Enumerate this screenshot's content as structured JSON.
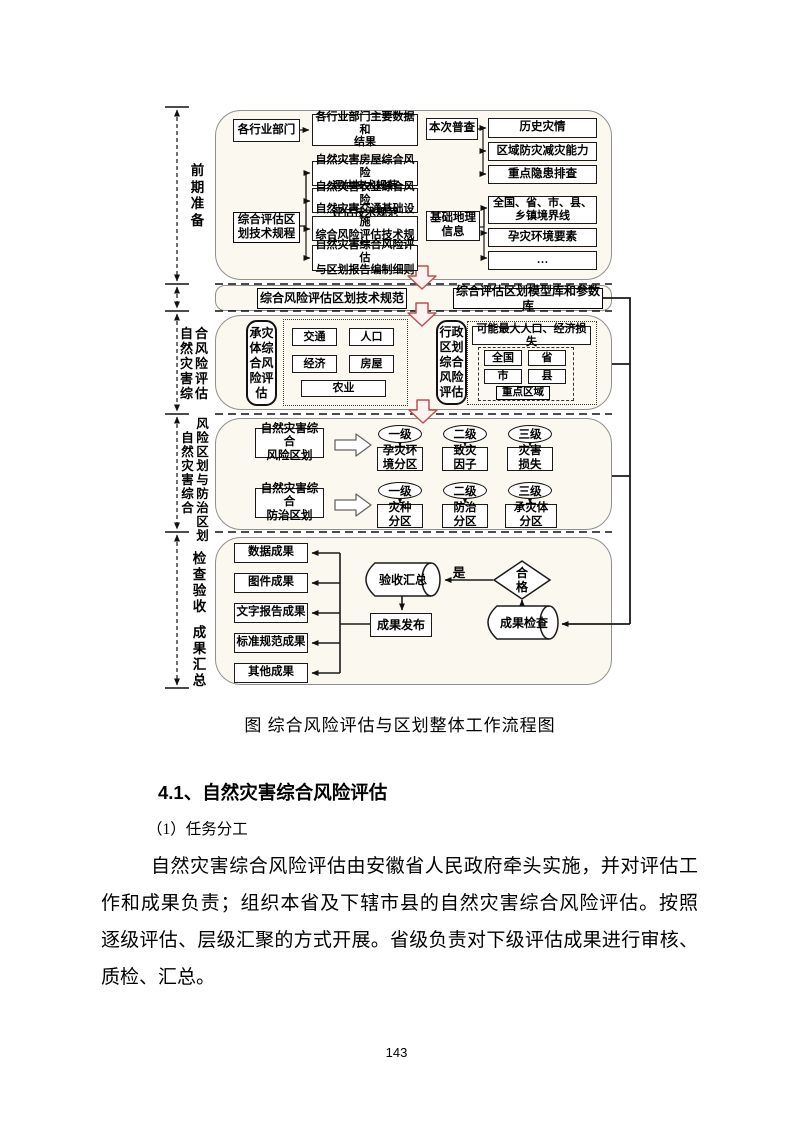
{
  "page": {
    "caption": "图 综合风险评估与区划整体工作流程图",
    "heading": "4.1、自然灾害综合风险评估",
    "subheading": "（1）任务分工",
    "paragraph_lines": [
      "自然灾害综合风险评估由安徽省人民政府牵头实施，并对评估工",
      "作和成果负责；组织本省及下辖市县的自然灾害综合风险评估。按照",
      "逐级评估、层级汇聚的方式开展。省级负责对下级评估成果进行审核、",
      "质检、汇总。"
    ],
    "page_number": "143"
  },
  "colors": {
    "accent_arrow": "#C0504D",
    "section_fill": "#FAF8EF",
    "line": "#1a1a1a"
  },
  "diagram": {
    "side_labels": {
      "prep": "前期准备",
      "assess_col1": "自然灾害综",
      "assess_col2": "合风险评估",
      "zoning_col1": "自然灾害综合",
      "zoning_col2": "风险区划与防治区划",
      "check_top": "检查验收",
      "check_bottom": "成果汇总"
    },
    "prep": {
      "dept": "各行业部门",
      "dept_data": "各行业部门主要数据和\n结果",
      "survey": "本次普查",
      "history": "历史灾情",
      "capacity": "区域防灾减灾能力",
      "hidden": "重点隐患排查",
      "tech_reg": "综合评估区\n划技术规程",
      "spec_house": "自然灾害房屋综合风险\n评估技术规范",
      "spec_agri": "自然灾害农业综合风险\n评估技术规范",
      "spec_traffic": "自然灾害交通基础设施\n综合风险评估技术规范",
      "spec_report": "自然灾害综合风险评估\n与区划报告编制细则",
      "geo": "基础地理\n信息",
      "boundary": "全国、省、市、县、\n乡镇境界线",
      "env": "孕灾环境要素",
      "more": "…"
    },
    "strip": {
      "left": "综合风险评估区划技术规范",
      "right": "综合评估区划模型库和参数库"
    },
    "assess": {
      "bearer": "承灾体综合风险评估",
      "items": [
        "交通",
        "人口",
        "经济",
        "房屋",
        "农业"
      ],
      "admin": "行政区划综合风险评估",
      "loss_title": "可能最大人口、经济损失",
      "regions": [
        "全国",
        "省",
        "市",
        "县"
      ],
      "key_region": "重点区域"
    },
    "zoning": {
      "risk": "自然灾害综合\n风险区划",
      "prevent": "自然灾害综合\n防治区划",
      "levels": [
        "一级",
        "二级",
        "三级"
      ],
      "risk_boxes": [
        "孕灾环\n境分区",
        "致灾\n因子",
        "灾害\n损失"
      ],
      "prevent_boxes": [
        "灾种\n分区",
        "防治\n分区",
        "承灾体\n分区"
      ]
    },
    "check": {
      "outputs": [
        "数据成果",
        "图件成果",
        "文字报告成果",
        "标准规范成果",
        "其他成果"
      ],
      "accept": "验收汇总",
      "publish": "成果发布",
      "yes_label": "是",
      "qualified": "合格",
      "inspect": "成果检查"
    }
  }
}
